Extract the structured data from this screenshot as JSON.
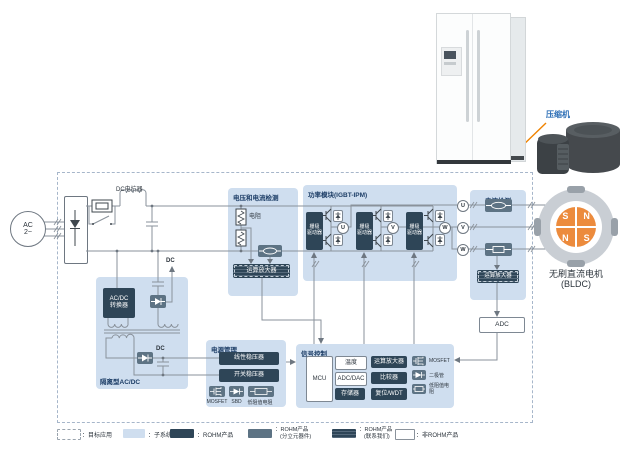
{
  "diagram": {
    "compressor_label": "压缩机",
    "motor": {
      "name_line1": "无刷直流电机",
      "name_line2": "(BLDC)",
      "poles": [
        "S",
        "N",
        "N",
        "S"
      ]
    },
    "ac_source": {
      "line1": "AC",
      "line2": "2~"
    },
    "labels": {
      "dc_reactor": "DC电抗器",
      "dc": "DC",
      "resistor": "电阻",
      "adc": "ADC"
    },
    "phases": [
      "U",
      "V",
      "W"
    ],
    "panels": {
      "vdet": {
        "title": "电压和电流检测",
        "opamp": "运算放大器"
      },
      "ipm": {
        "title": "功率模块(IGBT-IPM)",
        "gate_driver_l1": "栅极",
        "gate_driver_l2": "驱动器"
      },
      "idet": {
        "title": "电流检测",
        "opamp": "运算放大器"
      },
      "iso": {
        "title": "隔离型AC/DC",
        "conv_l1": "AC/DC",
        "conv_l2": "转换器"
      },
      "pmgmt": {
        "title": "电源管理",
        "linear": "线性稳压器",
        "switching": "开关稳压器",
        "icons": [
          "MOSFET",
          "SBD",
          "低阻值电阻"
        ]
      },
      "sig": {
        "title": "信号控制",
        "mcu": "MCU",
        "temp": "温度",
        "adcdac": "ADC/DAC",
        "mem": "存储器",
        "opamp": "运算放大器",
        "comp": "比较器",
        "wdt": "复位/WDT",
        "icons": [
          "MOSFET",
          "二极管",
          "低阻值电阻"
        ]
      }
    },
    "legend": [
      {
        "label": "：目标应用",
        "sub": ""
      },
      {
        "label": "：子系统",
        "sub": ""
      },
      {
        "label": "：ROHM产品",
        "sub": ""
      },
      {
        "label": "：ROHM产品",
        "sub": "(分立元器件)"
      },
      {
        "label": "：ROHM产品",
        "sub": "(联系我们)"
      },
      {
        "label": "：非ROHM产品",
        "sub": ""
      }
    ],
    "colors": {
      "panel": "#cfdeef",
      "navy": "#2e4557",
      "slate": "#5d7384",
      "wire": "#8a929b",
      "sym": "#3f474e",
      "accent_orange": "#f08300",
      "rotor_orange": "#ec8b3d",
      "title_blue": "#1c3d66"
    }
  }
}
